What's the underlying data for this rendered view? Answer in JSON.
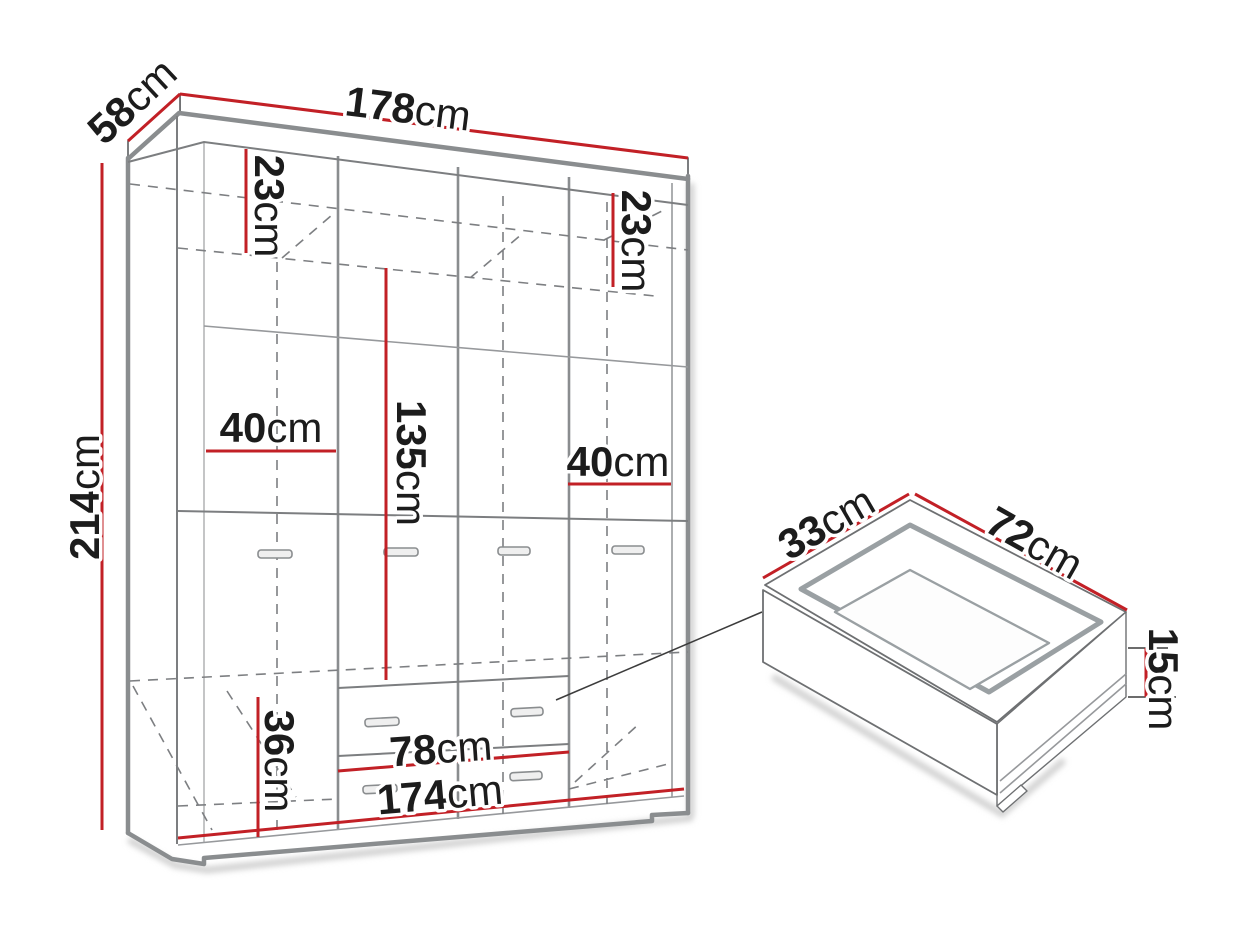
{
  "diagram_title": "wardrobe-dimensions-diagram",
  "colors": {
    "dimension_line": "#c22026",
    "outline_gray": "#8a8d8f",
    "label_text": "#1c1c1c"
  },
  "wardrobe": {
    "dims": {
      "top_width": {
        "value": "178",
        "unit": "cm"
      },
      "top_depth": {
        "value": "58",
        "unit": "cm"
      },
      "height": {
        "value": "214",
        "unit": "cm"
      },
      "top_shelf_left": {
        "value": "23",
        "unit": "cm"
      },
      "top_shelf_right": {
        "value": "23",
        "unit": "cm"
      },
      "left_section_width": {
        "value": "40",
        "unit": "cm"
      },
      "right_section_width": {
        "value": "40",
        "unit": "cm"
      },
      "hanging_height": {
        "value": "135",
        "unit": "cm"
      },
      "drawer_section_height": {
        "value": "36",
        "unit": "cm"
      },
      "drawer_front_width": {
        "value": "78",
        "unit": "cm"
      },
      "interior_width": {
        "value": "174",
        "unit": "cm"
      }
    }
  },
  "drawer_detail": {
    "dims": {
      "depth": {
        "value": "33",
        "unit": "cm"
      },
      "width": {
        "value": "72",
        "unit": "cm"
      },
      "height": {
        "value": "15",
        "unit": "cm"
      }
    }
  }
}
